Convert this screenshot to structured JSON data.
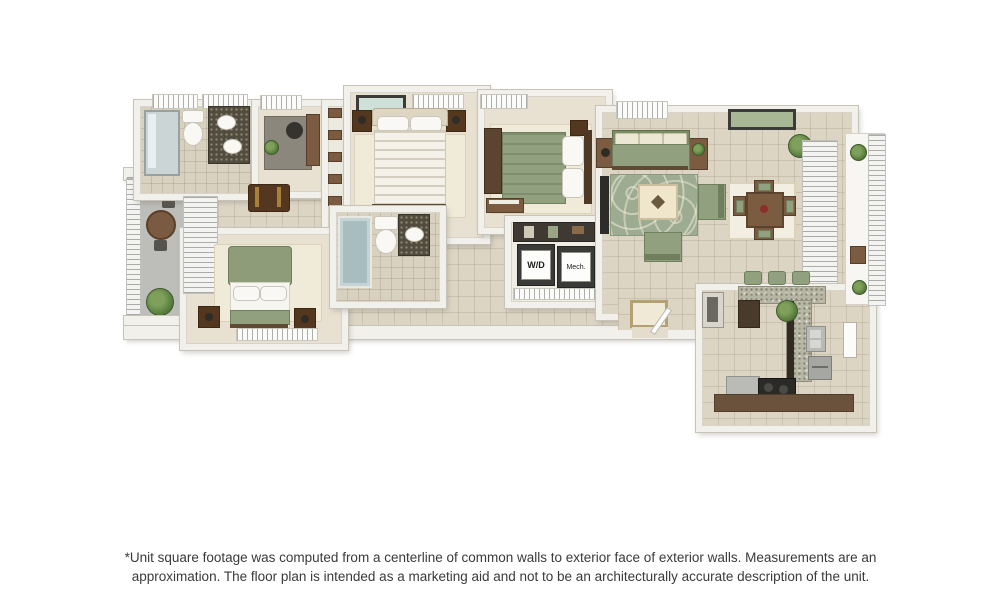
{
  "plan": {
    "labels": {
      "washer_dryer": "W/D",
      "mechanical": "Mech."
    },
    "palette": {
      "background": "#ffffff",
      "wall": "#f2f0ea",
      "tile_floor": "#ddd5c4",
      "bedroom_carpet": "#e8e1d1",
      "sage_green_furniture": "#91a07e",
      "cream_rug": "#f0ead9",
      "dark_wood": "#53381f",
      "granite_counter": "#b7b5a3",
      "tub_glass": "#a7bdbf",
      "balcony_floor": "#bdbdb9"
    }
  },
  "disclaimer": {
    "line1": "*Unit square footage was computed from a centerline of common walls to exterior face of exterior walls. Measurements are an",
    "line2": "approximation. The floor plan is intended as a marketing aid and not to be an architecturally accurate description of the unit."
  }
}
